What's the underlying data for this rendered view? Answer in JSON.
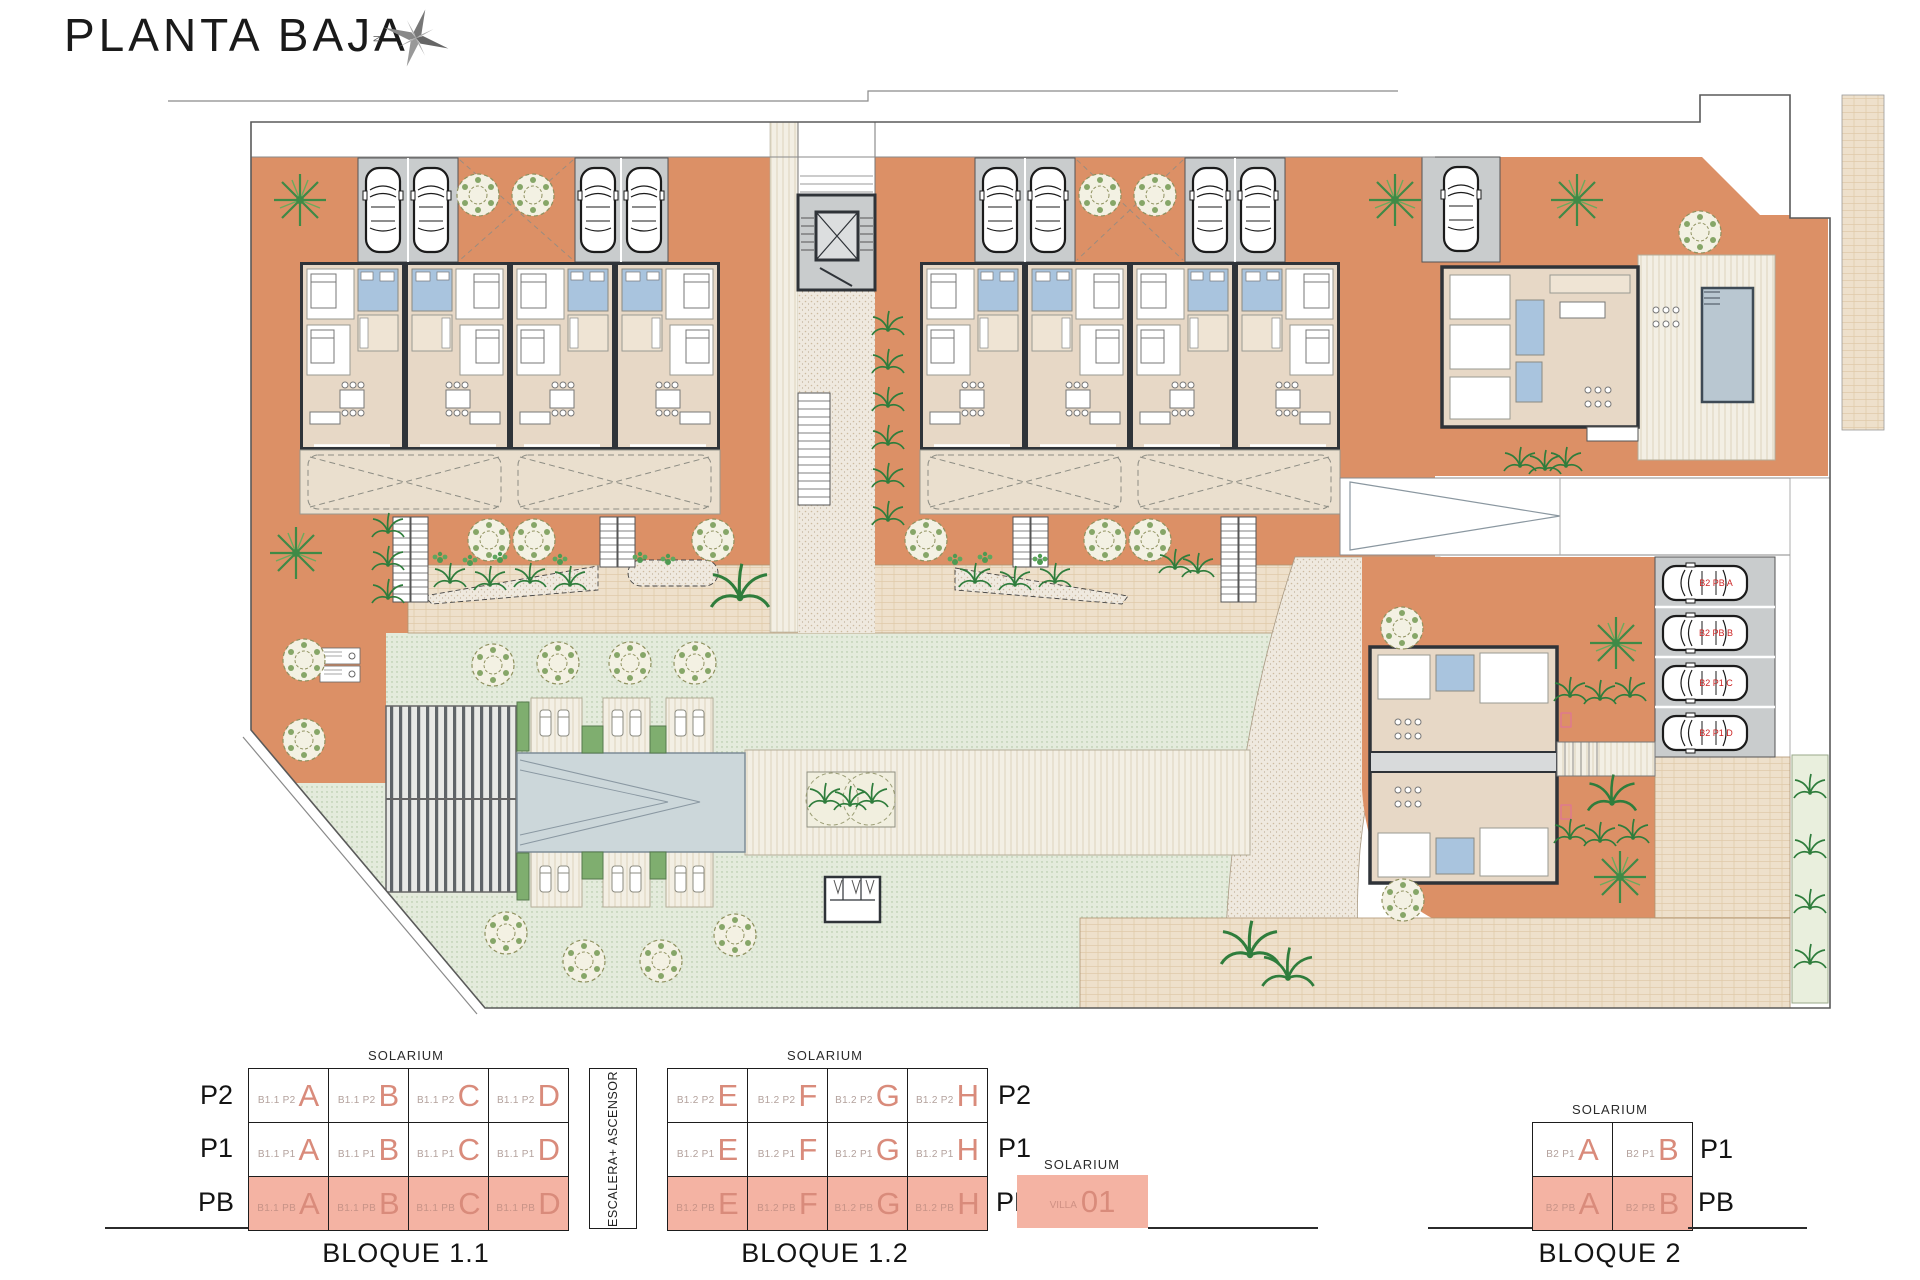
{
  "title": "PLANTA BAJA",
  "compass": {
    "north": "N"
  },
  "plan": {
    "parking_labels": [
      "B2 PB A",
      "B2 PB B",
      "B2 P1 C",
      "B2 P1 D"
    ]
  },
  "legend": {
    "solarium": "SOLARIUM",
    "core": "ESCALERA+ ASCENSOR",
    "b11": {
      "title": "BLOQUE 1.1",
      "floors": [
        "P2",
        "P1",
        "PB"
      ],
      "rows": [
        {
          "cells": [
            {
              "prefix": "B1.1 P2",
              "letter": "A"
            },
            {
              "prefix": "B1.1 P2",
              "letter": "B"
            },
            {
              "prefix": "B1.1 P2",
              "letter": "C"
            },
            {
              "prefix": "B1.1 P2",
              "letter": "D"
            }
          ]
        },
        {
          "cells": [
            {
              "prefix": "B1.1 P1",
              "letter": "A"
            },
            {
              "prefix": "B1.1 P1",
              "letter": "B"
            },
            {
              "prefix": "B1.1 P1",
              "letter": "C"
            },
            {
              "prefix": "B1.1 P1",
              "letter": "D"
            }
          ]
        },
        {
          "cells": [
            {
              "prefix": "B1.1 PB",
              "letter": "A"
            },
            {
              "prefix": "B1.1 PB",
              "letter": "B"
            },
            {
              "prefix": "B1.1 PB",
              "letter": "C"
            },
            {
              "prefix": "B1.1 PB",
              "letter": "D"
            }
          ]
        }
      ]
    },
    "b12": {
      "title": "BLOQUE 1.2",
      "floors": [
        "P2",
        "P1",
        "PB"
      ],
      "rows": [
        {
          "cells": [
            {
              "prefix": "B1.2 P2",
              "letter": "E"
            },
            {
              "prefix": "B1.2 P2",
              "letter": "F"
            },
            {
              "prefix": "B1.2 P2",
              "letter": "G"
            },
            {
              "prefix": "B1.2 P2",
              "letter": "H"
            }
          ]
        },
        {
          "cells": [
            {
              "prefix": "B1.2 P1",
              "letter": "E"
            },
            {
              "prefix": "B1.2 P1",
              "letter": "F"
            },
            {
              "prefix": "B1.2 P1",
              "letter": "G"
            },
            {
              "prefix": "B1.2 P1",
              "letter": "H"
            }
          ]
        },
        {
          "cells": [
            {
              "prefix": "B1.2 PB",
              "letter": "E"
            },
            {
              "prefix": "B1.2 PB",
              "letter": "F"
            },
            {
              "prefix": "B1.2 PB",
              "letter": "G"
            },
            {
              "prefix": "B1.2 PB",
              "letter": "H"
            }
          ]
        }
      ]
    },
    "villa": {
      "name": "VILLA",
      "number": "01"
    },
    "b2": {
      "title": "BLOQUE 2",
      "floors": [
        "P1",
        "PB"
      ],
      "rows": [
        {
          "cells": [
            {
              "prefix": "B2 P1",
              "letter": "A"
            },
            {
              "prefix": "B2 P1",
              "letter": "B"
            }
          ]
        },
        {
          "cells": [
            {
              "prefix": "B2 PB",
              "letter": "A"
            },
            {
              "prefix": "B2 PB",
              "letter": "B"
            }
          ]
        }
      ]
    }
  },
  "colors": {
    "terrace_orange": "#dc9066",
    "interior_beige": "#e7d8c6",
    "bath_blue": "#a9c4de",
    "garage_grey": "#c9cccd",
    "pool_grey_blue": "#ccd7da",
    "legend_salmon": "#f4b3a3",
    "legend_letter": "#d98b7b",
    "parking_label_red": "#cc2222"
  }
}
